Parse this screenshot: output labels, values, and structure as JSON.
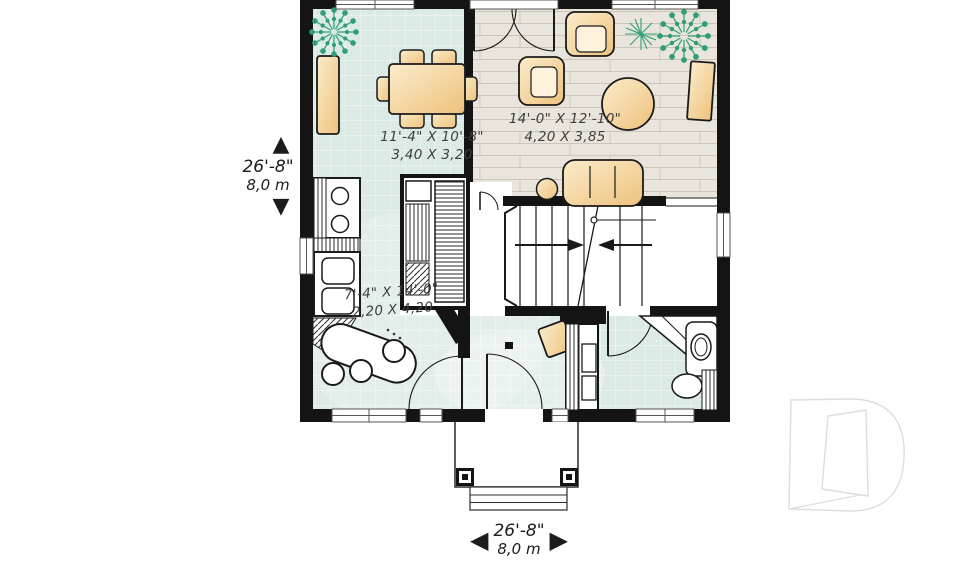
{
  "plan": {
    "rooms": {
      "dining": {
        "imperial": "11'-4\" X 10'-8\"",
        "metric": "3,40 X 3,20"
      },
      "living": {
        "imperial": "14'-0\" X 12'-10\"",
        "metric": "4,20 X 3,85"
      },
      "kitchen": {
        "imperial": "7'-4\" X 14'-0\"",
        "metric": "2,20 X 4,20"
      }
    },
    "dimensions": {
      "left": {
        "imperial": "26'-8\"",
        "metric": "8,0 m"
      },
      "bottom": {
        "imperial": "26'-8\"",
        "metric": "8,0 m"
      }
    }
  },
  "icons": {
    "arrow_up": "▲",
    "arrow_down": "▼",
    "arrow_left": "◀",
    "arrow_right": "▶"
  },
  "colors": {
    "wall": "#141414",
    "tile_floor": "#dbeae5",
    "wood_floor": "#eae5dc",
    "furniture": "#f1c782",
    "plant": "#2f9e79",
    "label_text": "#3e3e3e",
    "logo_outline": "#dedede"
  }
}
